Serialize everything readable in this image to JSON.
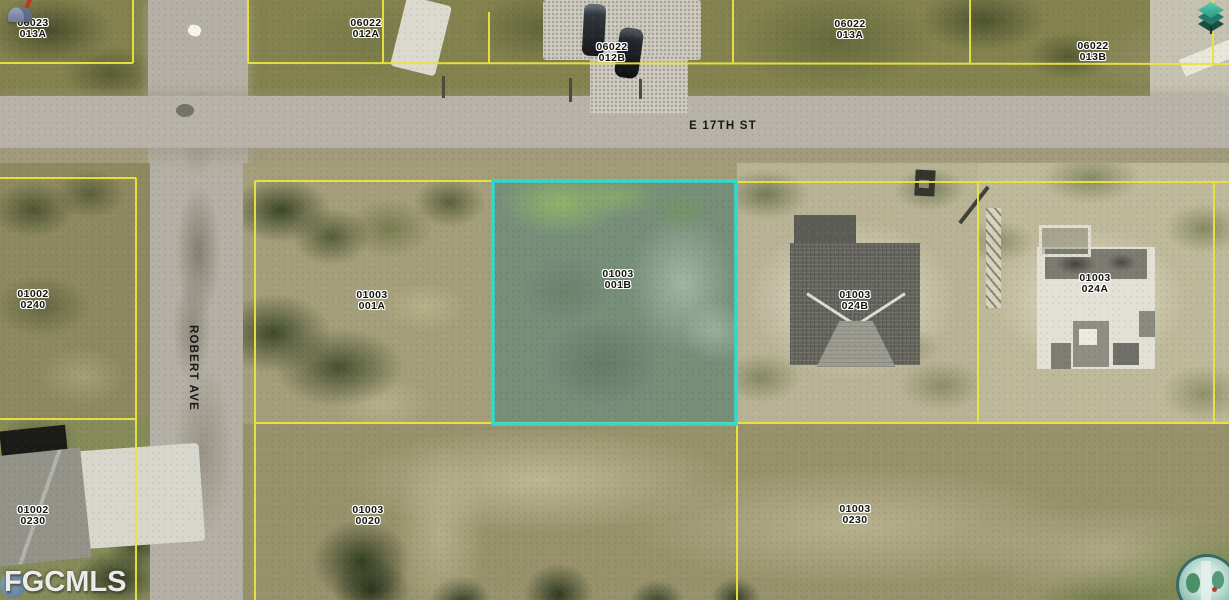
{
  "watermark": "FGCMLS",
  "streets": {
    "horizontal_label": "E 17TH ST",
    "vertical_label": "ROBERT AVE"
  },
  "highlighted_parcel": "01003 001B",
  "colors": {
    "parcel_line_yellow": "#eae43f",
    "highlight_teal": "#2fd9cf",
    "road_gray": "#b7b3a8"
  },
  "icons": {
    "top_left": "mailbox-icon",
    "top_right": "3d-view-icon",
    "bottom_right": "globe-logo-icon"
  },
  "parcels": [
    {
      "id": "06023",
      "lot": "013A"
    },
    {
      "id": "06022",
      "lot": "012A"
    },
    {
      "id": "06022",
      "lot": "012B"
    },
    {
      "id": "06022",
      "lot": "013A"
    },
    {
      "id": "06022",
      "lot": "013B"
    },
    {
      "id": "01002",
      "lot": "0240"
    },
    {
      "id": "01003",
      "lot": "001A"
    },
    {
      "id": "01003",
      "lot": "001B"
    },
    {
      "id": "01003",
      "lot": "024B"
    },
    {
      "id": "01003",
      "lot": "024A"
    },
    {
      "id": "01002",
      "lot": "0230"
    },
    {
      "id": "01003",
      "lot": "0020"
    },
    {
      "id": "01003",
      "lot": "0230"
    }
  ]
}
